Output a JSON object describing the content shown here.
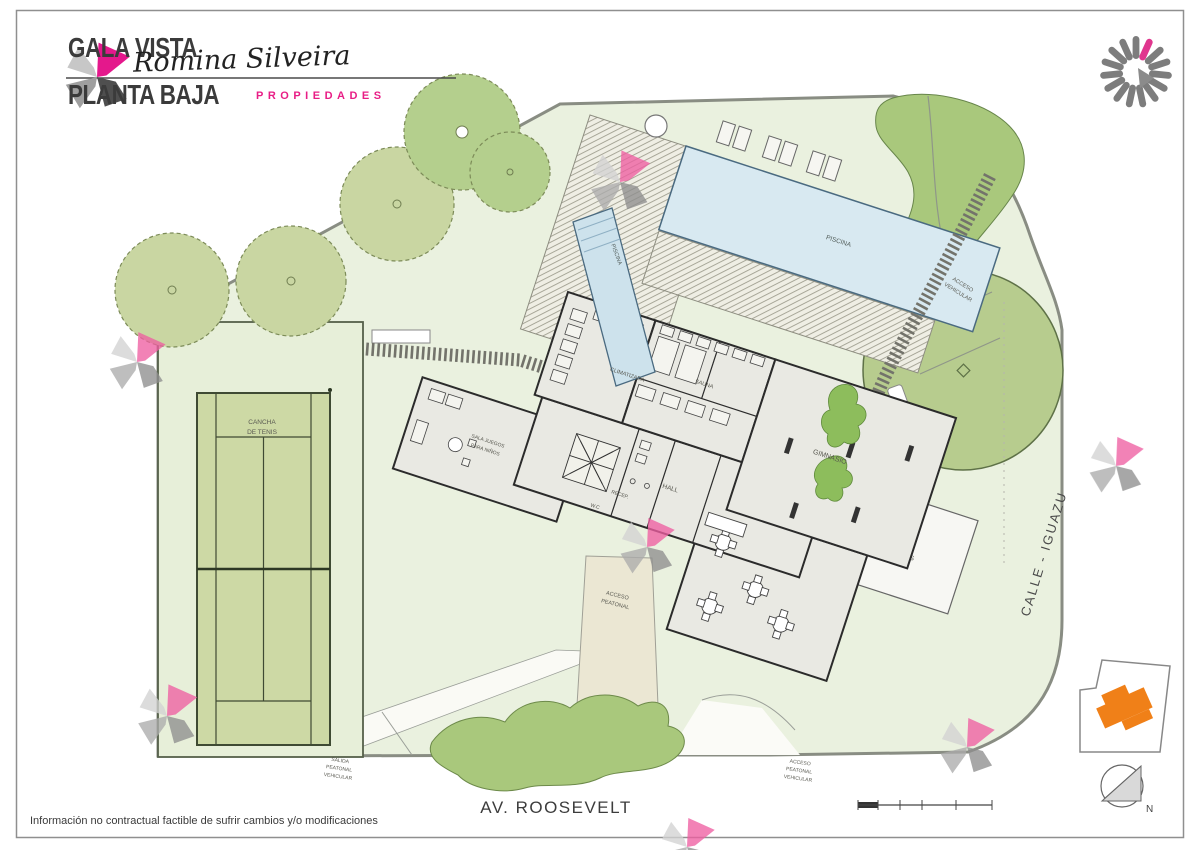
{
  "header": {
    "title1": "GALA VISTA",
    "title2": "PLANTA BAJA",
    "brand": "Romina Silveira",
    "brand_sub": "PROPIEDADES"
  },
  "plan": {
    "streets": {
      "roosevelt": "AV. ROOSEVELT",
      "iguazu": "CALLE - IGUAZU"
    },
    "rooms": {
      "piscina": "PISCINA",
      "climatizada": "CLIMATIZADA",
      "sauna": "SAUNA",
      "gimnasio": "GIMNASIO",
      "hall": "HALL",
      "recepcion": "RECEP.",
      "wc": "W.C",
      "sala_juegos": [
        "SALA JUEGOS",
        "PARA NIÑOS"
      ],
      "patio_ingles": [
        "PATIO",
        "INGLES"
      ],
      "cancha": [
        "CANCHA",
        "DE TENIS"
      ]
    },
    "accesses": {
      "vehicular": [
        "ACCESO",
        "VEHICULAR"
      ],
      "peatonal": [
        "ACCESO",
        "PEATONAL"
      ],
      "salida": [
        "SALIDA",
        "PEATONAL",
        "VEHICULAR"
      ],
      "peatonal_vehicular": [
        "ACCESO",
        "PEATONAL",
        "VEHICULAR"
      ]
    },
    "compass": "N"
  },
  "footer": {
    "disclaimer": "Información no contractual factible de sufrir cambios y/o modificaciones"
  },
  "colors": {
    "brand_magenta": "#e4188c",
    "keyplan_orange": "#f08018",
    "site_green": "#eaf1df",
    "tree_olive": "#c9d6a2",
    "tree_bright": "#b4cf8d",
    "hedge_green": "#a9c87c",
    "pool_blue": "#d8e9f1"
  }
}
